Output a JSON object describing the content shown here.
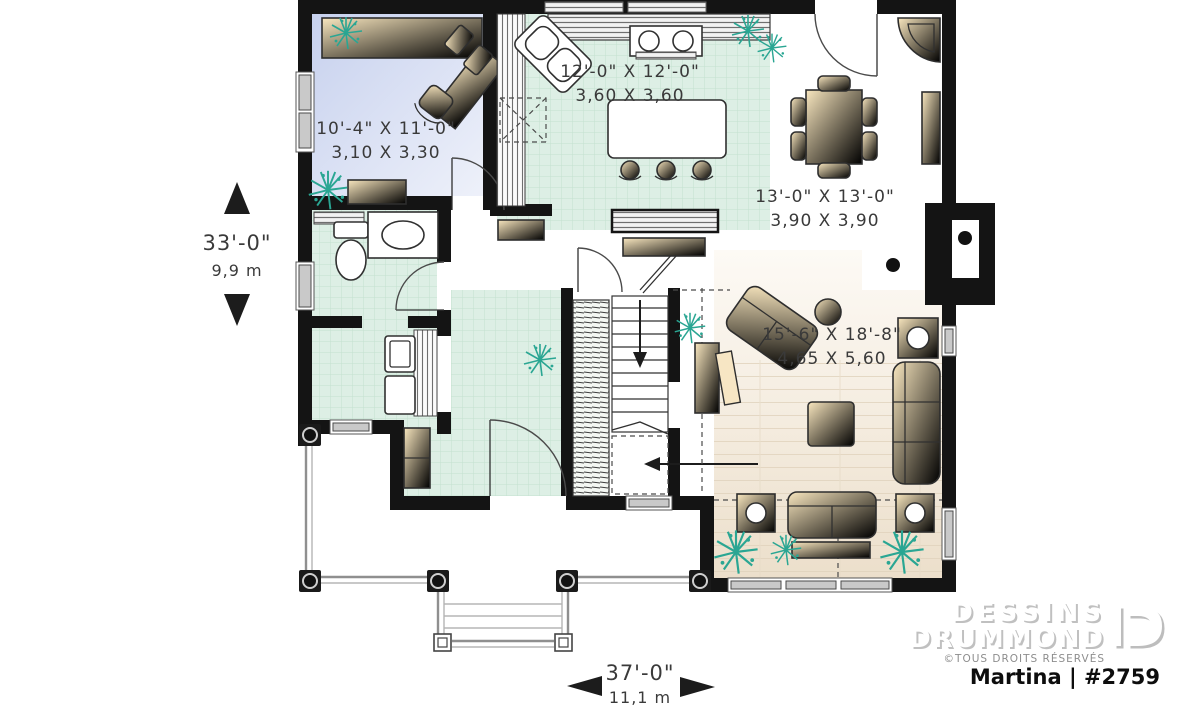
{
  "plan": {
    "rooms": [
      {
        "id": "office",
        "imperial": "10'-4\" X 11'-0\"",
        "metric": "3,10 X 3,30"
      },
      {
        "id": "kitchen",
        "imperial": "12'-0\" X 12'-0\"",
        "metric": "3,60 X 3,60"
      },
      {
        "id": "dining",
        "imperial": "13'-0\" X 13'-0\"",
        "metric": "3,90 X 3,90"
      },
      {
        "id": "living",
        "imperial": "15'-6\" X 18'-8\"",
        "metric": "4,65 X 5,60"
      }
    ],
    "overall_depth": {
      "imperial": "33'-0\"",
      "metric": "9,9 m"
    },
    "overall_width": {
      "imperial": "37'-0\"",
      "metric": "11,1 m"
    }
  },
  "branding": {
    "brand_line1": "DESSINS",
    "brand_line2": "DRUMMOND",
    "rights": "©TOUS DROITS RÉSERVÉS",
    "plan_name": "Martina | #2759"
  },
  "colors": {
    "wall": "#141414",
    "tile_floor": "#ddeee4",
    "office_floor": "#ccd5ef",
    "wood_floor": "#efe3d2",
    "furniture": "#f3d596",
    "plant": "#2aa693"
  }
}
